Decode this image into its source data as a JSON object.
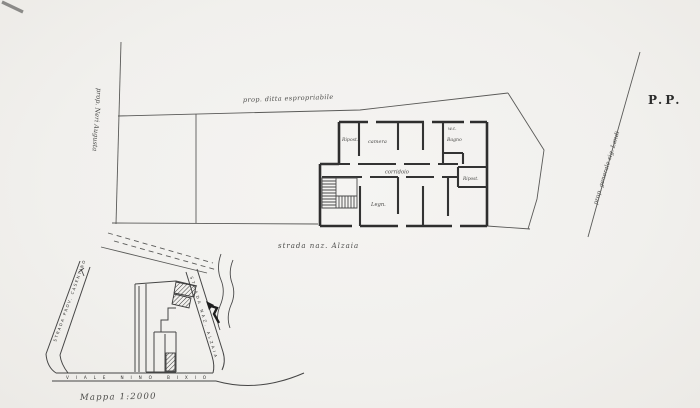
{
  "colors": {
    "paper": "#f1f0ed",
    "ink": "#2e2e2e",
    "ink_light": "#5a5a58"
  },
  "plan": {
    "sheet_label": "P.P.",
    "owner_left": "prop. Neri Augusta",
    "owner_top": "prop. ditta espropriabile",
    "owner_right": "prop. generale sig. Landi",
    "street_label": "strada naz. Alzaia",
    "rooms": {
      "storage_upper": "Ripost.",
      "camera": "camera",
      "wc": "w.c.",
      "bath": "Bagno",
      "corridor": "corridoio",
      "storage_right": "Ripost.",
      "wood_store": "Legn."
    }
  },
  "site_map": {
    "street_left": "STRADA PROV. CASENTINO",
    "street_bottom": "VIALE NINO BIXIO",
    "street_right": "STRADA NAZ. ALZAIA",
    "caption": "Mappa 1:2000"
  }
}
